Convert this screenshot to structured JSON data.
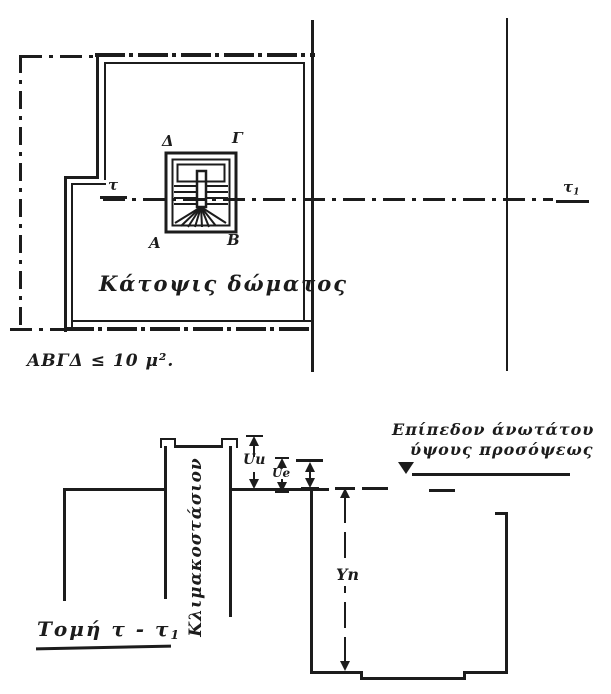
{
  "plan": {
    "title": "Κάτοψις δώματος",
    "area_note": "ΑΒΓΔ ≤ 10 μ².",
    "section_mark_left": "τ",
    "section_mark_right_main": "τ",
    "section_mark_right_sub": "1",
    "stair_corners": {
      "top_left": "Δ",
      "top_right": "Γ",
      "bottom_left": "Α",
      "bottom_right": "Β"
    }
  },
  "section": {
    "title_main": "Τομή τ - τ",
    "title_sub": "1",
    "stairwell_label": "Κλιμακοστάσιον",
    "level_note_line1": "Επίπεδον άνωτάτου",
    "level_note_line2": "ύψους προσόψεως",
    "dims": {
      "tower_height": "Uu",
      "secondary_height": "Ue",
      "facade_height": "Yn"
    }
  },
  "colors": {
    "ink": "#1c1c1c",
    "paper": "#ffffff"
  }
}
